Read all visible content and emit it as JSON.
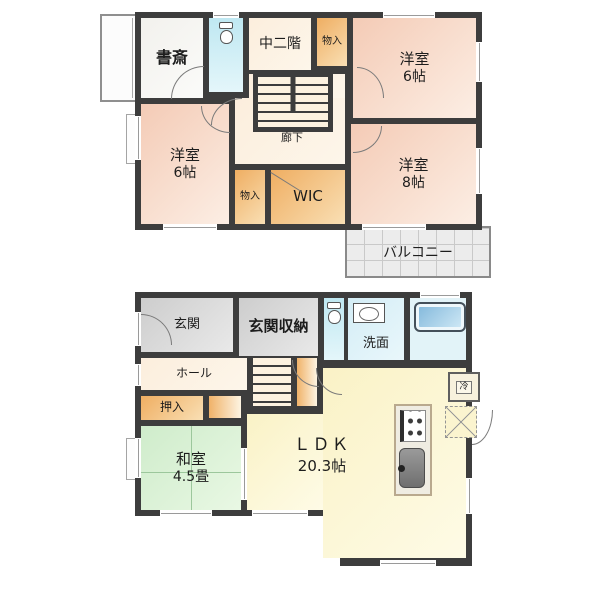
{
  "palette": {
    "wall": "#3d3d3d",
    "western_room_pink": "#f4cbb6",
    "storage_orange": "#efae62",
    "corridor_cream": "#fceedd",
    "tatami_green": "#cfeccb",
    "ldk_yellow": "#faf2c6",
    "entrance_gray": "#cdcdcd",
    "water_cyan": "#bfe8f2",
    "bathtub_blue": "#7fb6da",
    "balcony_gray": "#ececec"
  },
  "floor2": {
    "study": "書斎",
    "mezzanine": "中二階",
    "closet_top": "物入",
    "bedroom_top_right_name": "洋室",
    "bedroom_top_right_size": "6帖",
    "bedroom_left_name": "洋室",
    "bedroom_left_size": "6帖",
    "hallway": "廊下",
    "bedroom_right_name": "洋室",
    "bedroom_right_size": "8帖",
    "closet_mid": "物入",
    "wic": "WIC",
    "balcony": "バルコニー"
  },
  "floor1": {
    "entrance": "玄関",
    "entrance_storage": "玄関収納",
    "washroom": "洗面",
    "hall": "ホール",
    "oshiire": "押入",
    "washitsu_name": "和室",
    "washitsu_size": "4.5畳",
    "ldk_name": "ＬＤＫ",
    "ldk_size": "20.3帖",
    "fridge": "冷"
  }
}
